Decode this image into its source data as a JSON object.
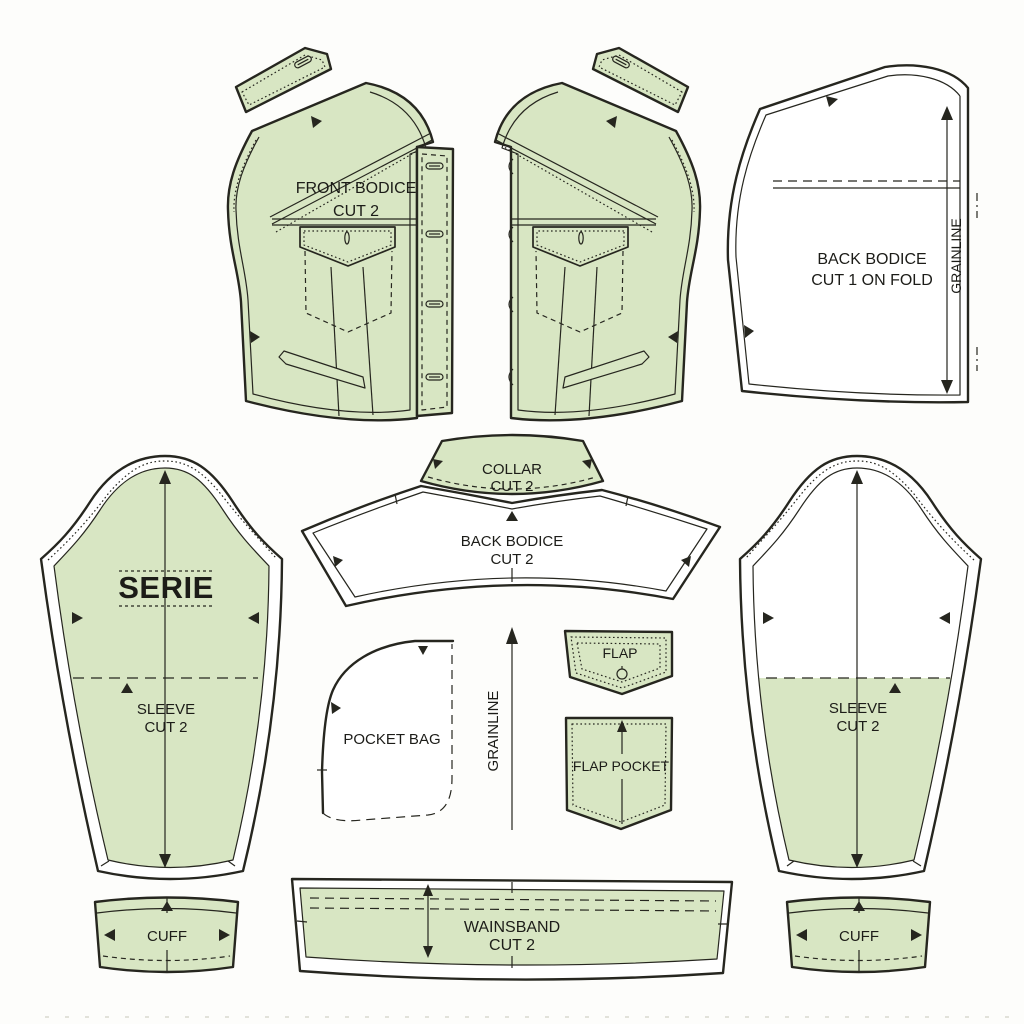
{
  "page": {
    "background": "#fdfdfb",
    "description": "sewing pattern layout sheet"
  },
  "colors": {
    "fabric_fill": "#d8e6c3",
    "outline": "#26261f",
    "label_text": "#1c1c18",
    "paper_white": "#ffffff"
  },
  "labels": {
    "front_bodice": {
      "line1": "FRONT BODICE",
      "line2": "CUT 2"
    },
    "back_bodice_fold": {
      "line1": "BACK BODICE",
      "line2": "CUT 1 ON FOLD",
      "grainline": "GRAINLINE"
    },
    "sleeve_left": {
      "stamp": "SERIE",
      "line1": "SLEEVE",
      "line2": "CUT 2"
    },
    "collar": {
      "line1": "COLLAR",
      "line2": "CUT 2"
    },
    "back_yoke": {
      "line1": "BACK BODICE",
      "line2": "CUT 2"
    },
    "pocket_bag": {
      "line1": "POCKET BAG"
    },
    "center_grainline": {
      "label": "GRAINLINE"
    },
    "flap": {
      "line1": "FLAP"
    },
    "flap_pocket": {
      "line1": "FLAP POCKET"
    },
    "sleeve_right": {
      "line1": "SLEEVE",
      "line2": "CUT 2"
    },
    "cuff_left": {
      "line1": "CUFF"
    },
    "waistband": {
      "line1": "WAINSBAND",
      "line2": "CUT 2"
    },
    "cuff_right": {
      "line1": "CUFF"
    }
  }
}
